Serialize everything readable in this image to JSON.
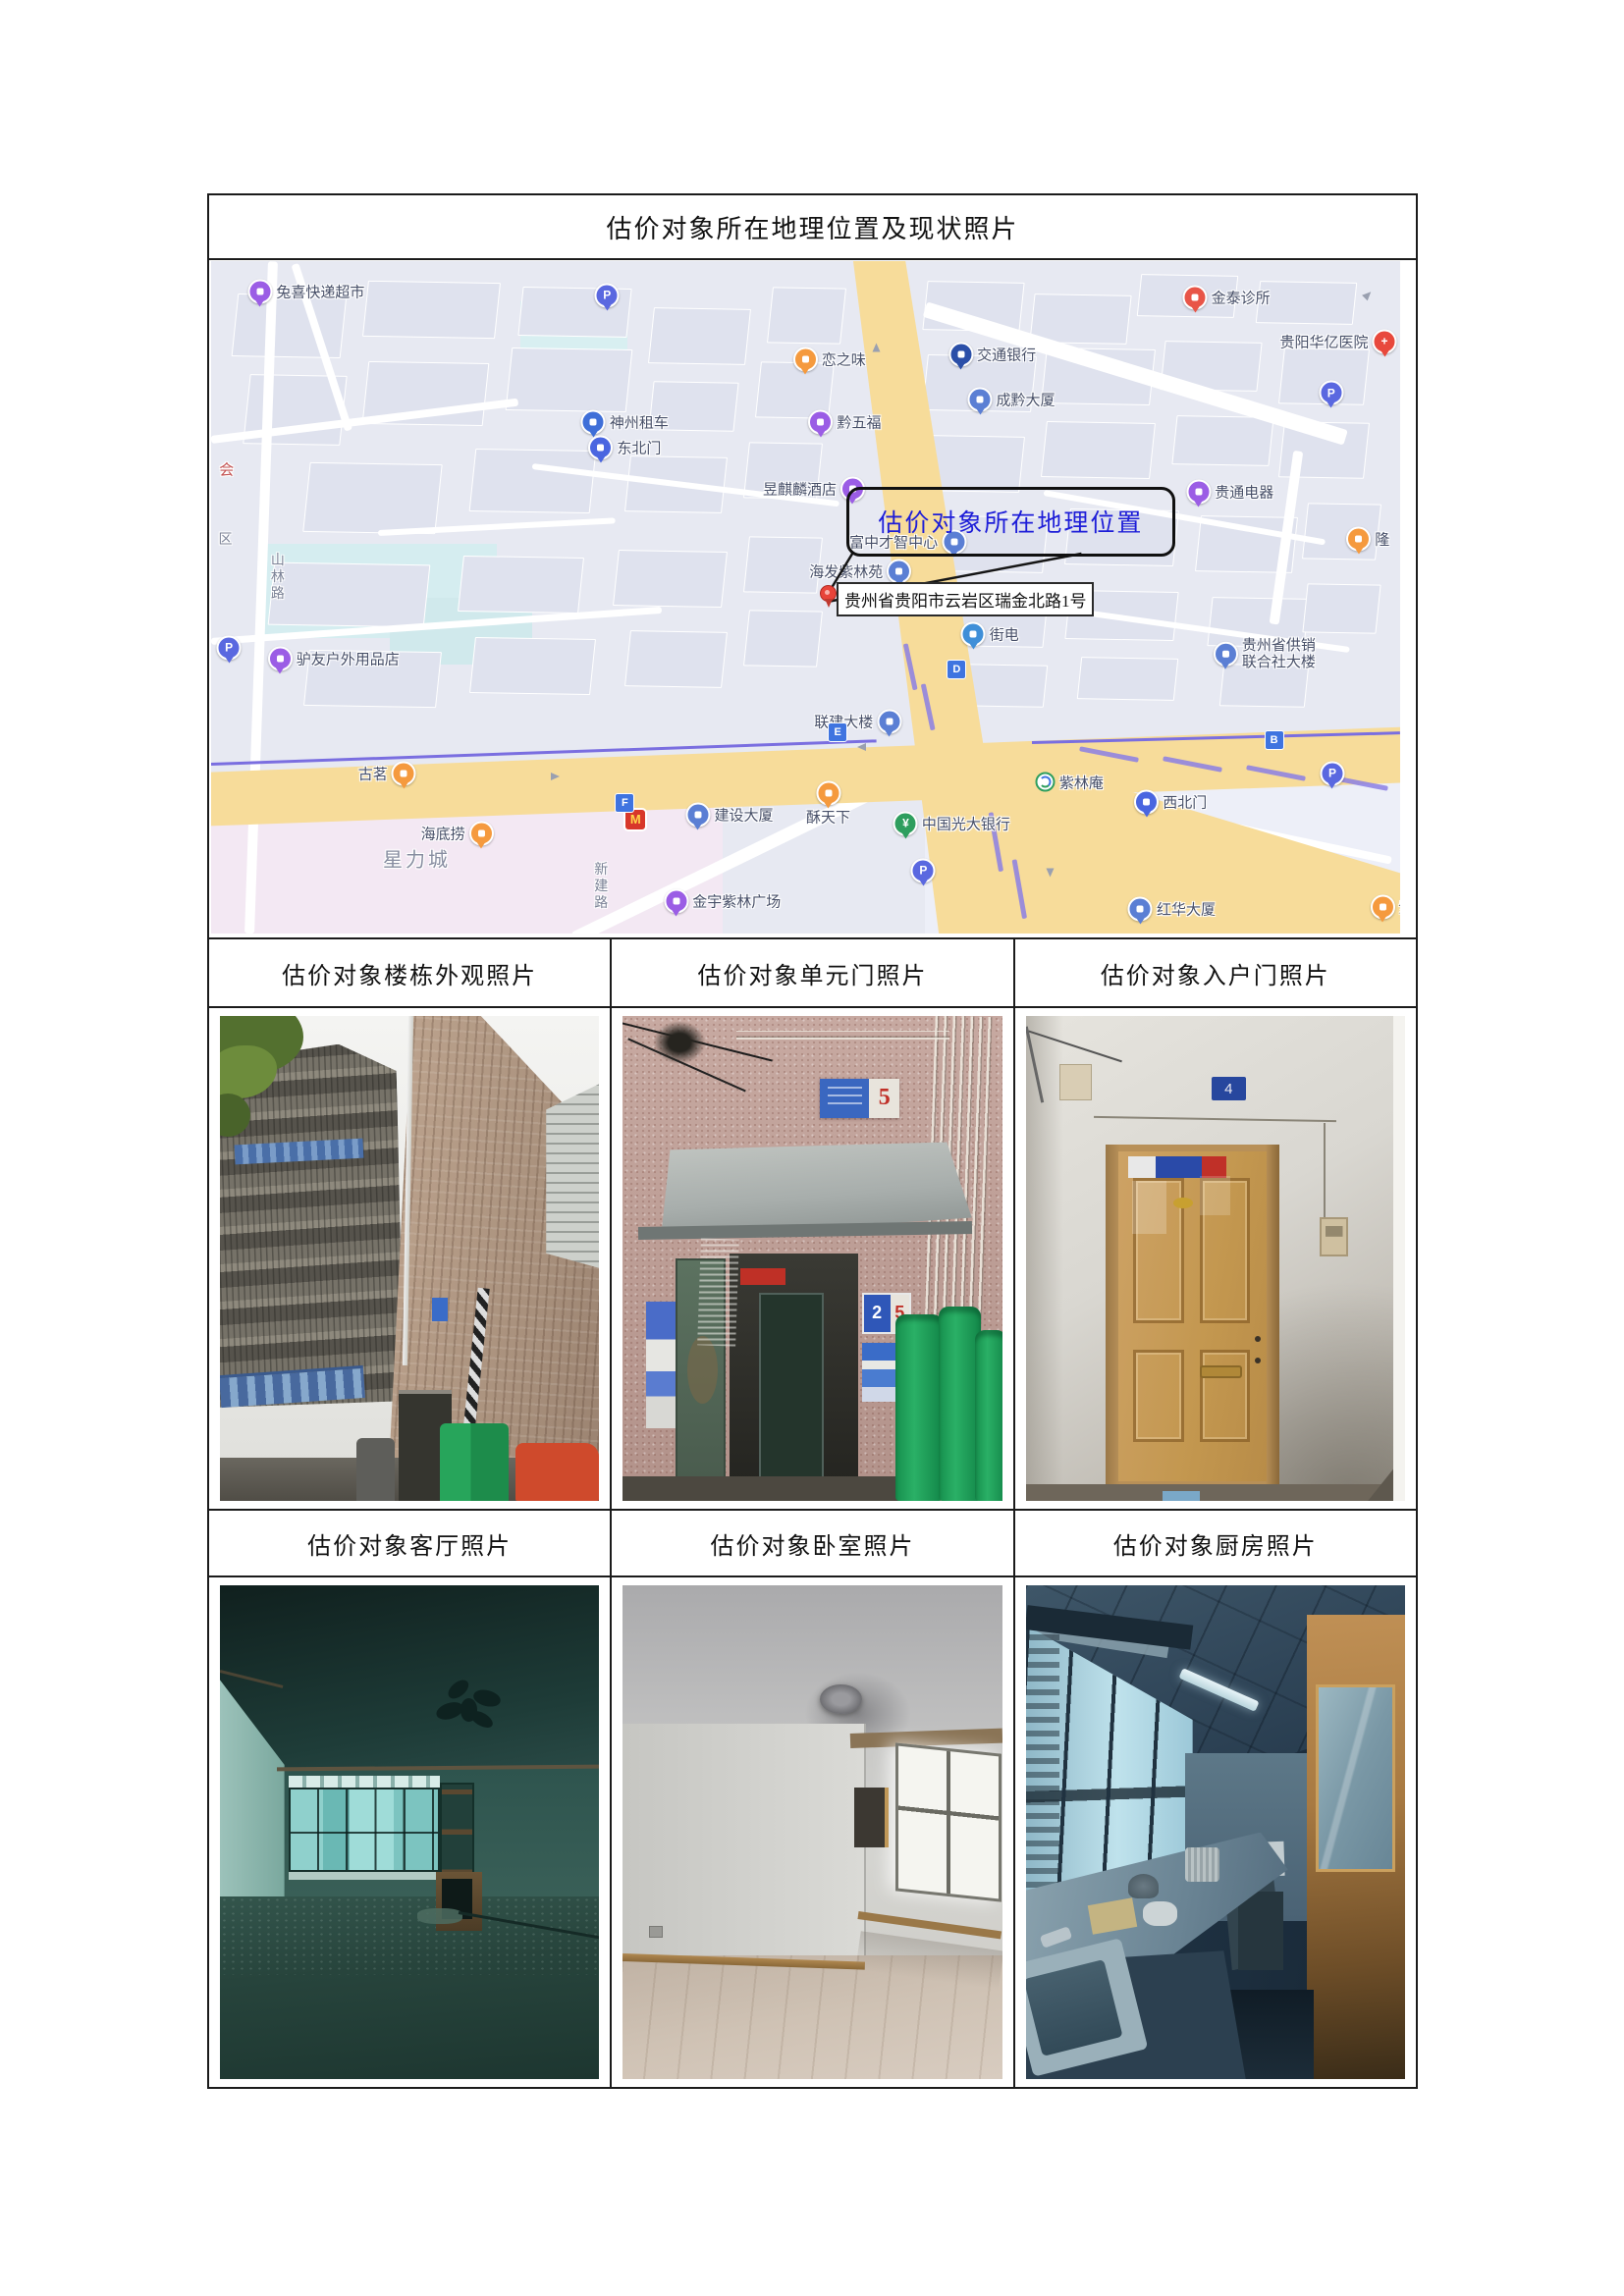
{
  "document": {
    "title": "估价对象所在地理位置及现状照片"
  },
  "photo_sections": {
    "row1": [
      "估价对象楼栋外观照片",
      "估价对象单元门照片",
      "估价对象入户门照片"
    ],
    "row2": [
      "估价对象客厅照片",
      "估价对象卧室照片",
      "估价对象厨房照片"
    ]
  },
  "photos": {
    "unit_door": {
      "street_plate_number": "5",
      "unit_plate_main": "2",
      "unit_plate_side": "5"
    },
    "entry_door": {
      "door_plate_number": "4"
    }
  },
  "map": {
    "callout_text": "估价对象所在地理位置",
    "address_label": "贵州省贵阳市云岩区瑞金北路1号",
    "colors": {
      "background": "#e7e9f2",
      "road_yellow": "#f7dc9a",
      "metro_purple": "#7a6ee0",
      "callout_blue": "#1d1dd8",
      "pin_red": "#e8443a"
    },
    "pois": [
      {
        "text": "兔喜快递超市",
        "kind": "pin",
        "icon": "courier-shop-icon",
        "color": "#9b5de5",
        "x": 8.0,
        "y": 4.5,
        "side": "right"
      },
      {
        "text": "恋之味",
        "kind": "pin",
        "icon": "food-icon",
        "color": "#f59a3e",
        "x": 52.0,
        "y": 14.6,
        "side": "right"
      },
      {
        "text": "交通银行",
        "kind": "pin",
        "icon": "bank-icon",
        "color": "#2b4fa8",
        "x": 65.7,
        "y": 13.9,
        "side": "right"
      },
      {
        "text": "金泰诊所",
        "kind": "pin",
        "icon": "clinic-icon",
        "color": "#e85548",
        "x": 85.4,
        "y": 5.4,
        "side": "right"
      },
      {
        "text": "贵阳华亿医院",
        "kind": "pin",
        "icon": "hospital-icon",
        "color": "#e8483c",
        "glyph": "+",
        "x": 94.8,
        "y": 11.9,
        "side": "left"
      },
      {
        "text": "成黔大厦",
        "kind": "pin",
        "icon": "building-icon",
        "color": "#5b7fd4",
        "x": 67.3,
        "y": 20.6,
        "side": "right"
      },
      {
        "text": "神州租车",
        "kind": "pin",
        "icon": "car-rental-icon",
        "color": "#3f6fd8",
        "x": 34.8,
        "y": 23.9,
        "side": "right"
      },
      {
        "text": "东北门",
        "kind": "pin",
        "icon": "gate-icon",
        "color": "#4a66e0",
        "x": 34.8,
        "y": 27.7,
        "side": "right"
      },
      {
        "text": "昱麒麟酒店",
        "kind": "pin",
        "icon": "hotel-icon",
        "color": "#9b5de5",
        "x": 50.7,
        "y": 33.8,
        "side": "left"
      },
      {
        "text": "黔五福",
        "kind": "pin",
        "icon": "shop-icon",
        "color": "#9b5de5",
        "x": 53.3,
        "y": 23.9,
        "side": "right"
      },
      {
        "text": "贵通电器",
        "kind": "pin",
        "icon": "electronics-shop-icon",
        "color": "#9b5de5",
        "x": 85.7,
        "y": 34.3,
        "side": "right"
      },
      {
        "text": "隆",
        "kind": "pin",
        "icon": "shop-icon",
        "color": "#f59a3e",
        "x": 97.3,
        "y": 41.3,
        "side": "right"
      },
      {
        "text": "富中才智中心",
        "kind": "pin",
        "icon": "building-icon",
        "color": "#5b7fd4",
        "x": 58.6,
        "y": 41.7,
        "side": "left"
      },
      {
        "text": "海发紫林苑",
        "kind": "pin",
        "icon": "residence-icon",
        "color": "#5b7fd4",
        "x": 54.6,
        "y": 46.1,
        "side": "left"
      },
      {
        "text": "街电",
        "kind": "pin",
        "icon": "charger-icon",
        "color": "#3f8fd8",
        "x": 65.5,
        "y": 55.5,
        "side": "right"
      },
      {
        "text": "贵州省供销\n联合社大楼",
        "kind": "pin",
        "icon": "building-icon",
        "color": "#5b7fd4",
        "x": 88.6,
        "y": 58.4,
        "side": "right",
        "multiline": true
      },
      {
        "text": "联建大楼",
        "kind": "pin",
        "icon": "building-icon",
        "color": "#5b7fd4",
        "x": 54.4,
        "y": 68.4,
        "side": "left"
      },
      {
        "text": "驴友户外用品店",
        "kind": "pin",
        "icon": "outdoor-shop-icon",
        "color": "#9b5de5",
        "x": 10.3,
        "y": 59.1,
        "side": "right"
      },
      {
        "text": "古茗",
        "kind": "pin",
        "icon": "tea-shop-icon",
        "color": "#f59a3e",
        "x": 14.8,
        "y": 76.2,
        "side": "left"
      },
      {
        "text": "紫林庵",
        "kind": "station",
        "icon": "metro-station-icon",
        "color": "#2e9e5e",
        "x": 72.2,
        "y": 77.5,
        "side": "right"
      },
      {
        "text": "西北门",
        "kind": "pin",
        "icon": "gate-icon",
        "color": "#4a66e0",
        "x": 80.7,
        "y": 80.4,
        "side": "right"
      },
      {
        "text": "中国光大银行",
        "kind": "pin",
        "icon": "bank-icon",
        "color": "#2e9e5e",
        "glyph": "¥",
        "x": 62.3,
        "y": 83.6,
        "side": "right"
      },
      {
        "text": "红华大厦",
        "kind": "pin",
        "icon": "building-icon",
        "color": "#5b7fd4",
        "x": 80.8,
        "y": 96.4,
        "side": "right"
      },
      {
        "text": "紫",
        "kind": "pin",
        "icon": "shop-icon",
        "color": "#f59a3e",
        "x": 99.3,
        "y": 96.1,
        "side": "right"
      },
      {
        "text": "海底捞",
        "kind": "pin",
        "icon": "restaurant-icon",
        "color": "#f59a3e",
        "x": 20.7,
        "y": 85.1,
        "side": "left"
      },
      {
        "text": "星力城",
        "kind": "text",
        "cls": "big",
        "x": 17.3,
        "y": 88.8
      },
      {
        "text": "",
        "kind": "mcd",
        "icon": "mcdonalds-icon",
        "color": "#d8372a",
        "glyph": "M",
        "x": 35.7,
        "y": 83.0,
        "side": "none"
      },
      {
        "text": "酥天下",
        "kind": "pin",
        "icon": "bakery-icon",
        "color": "#f59a3e",
        "x": 51.9,
        "y": 80.7,
        "side": "below"
      },
      {
        "text": "建设大厦",
        "kind": "pin",
        "icon": "building-icon",
        "color": "#5b7fd4",
        "x": 43.6,
        "y": 82.3,
        "side": "right"
      },
      {
        "text": "金宇紫林广场",
        "kind": "pin",
        "icon": "plaza-icon",
        "color": "#9b5de5",
        "x": 43.0,
        "y": 95.2,
        "side": "right"
      },
      {
        "text": "",
        "kind": "pin",
        "icon": "parking-icon",
        "color": "#5a68e0",
        "glyph": "P",
        "x": 33.3,
        "y": 5.1,
        "side": "none"
      },
      {
        "text": "",
        "kind": "pin",
        "icon": "parking-icon",
        "color": "#5a68e0",
        "glyph": "P",
        "x": 94.2,
        "y": 19.6,
        "side": "none"
      },
      {
        "text": "",
        "kind": "pin",
        "icon": "parking-icon",
        "color": "#5a68e0",
        "glyph": "P",
        "x": 1.5,
        "y": 57.5,
        "side": "none"
      },
      {
        "text": "",
        "kind": "pin",
        "icon": "parking-icon",
        "color": "#5a68e0",
        "glyph": "P",
        "x": 94.3,
        "y": 76.2,
        "side": "none"
      },
      {
        "text": "",
        "kind": "pin",
        "icon": "parking-icon",
        "color": "#5a68e0",
        "glyph": "P",
        "x": 59.9,
        "y": 90.6,
        "side": "none"
      },
      {
        "text": "",
        "kind": "sq",
        "icon": "metro-entrance-icon",
        "color": "#3f74e0",
        "glyph": "B",
        "x": 89.4,
        "y": 71.3,
        "side": "none"
      },
      {
        "text": "",
        "kind": "sq",
        "icon": "metro-entrance-icon",
        "color": "#3f74e0",
        "glyph": "D",
        "x": 62.7,
        "y": 60.7,
        "side": "none"
      },
      {
        "text": "",
        "kind": "sq",
        "icon": "metro-entrance-icon",
        "color": "#3f74e0",
        "glyph": "E",
        "x": 52.7,
        "y": 70.0,
        "side": "none"
      },
      {
        "text": "",
        "kind": "sq",
        "icon": "metro-entrance-icon",
        "color": "#3f74e0",
        "glyph": "F",
        "x": 34.8,
        "y": 80.6,
        "side": "none"
      },
      {
        "text": "会",
        "kind": "text",
        "cls": "red",
        "x": 1.3,
        "y": 30.9
      },
      {
        "text": "区",
        "kind": "text",
        "cls": "road",
        "x": 1.2,
        "y": 41.3
      },
      {
        "text": "山林路",
        "kind": "text",
        "cls": "road",
        "vertical": true,
        "x": 5.6,
        "y": 47.0
      },
      {
        "text": "新建路",
        "kind": "text",
        "cls": "road",
        "vertical": true,
        "x": 32.8,
        "y": 93.0
      }
    ],
    "arrows": [
      {
        "x": 55.4,
        "y": 11.9,
        "rot": -90
      },
      {
        "x": 96.9,
        "y": 4.3,
        "rot": -45
      },
      {
        "x": 54.0,
        "y": 71.7,
        "rot": 180
      },
      {
        "x": 70.0,
        "y": 90.6,
        "rot": 90
      },
      {
        "x": 28.6,
        "y": 76.1,
        "rot": 0
      }
    ]
  }
}
